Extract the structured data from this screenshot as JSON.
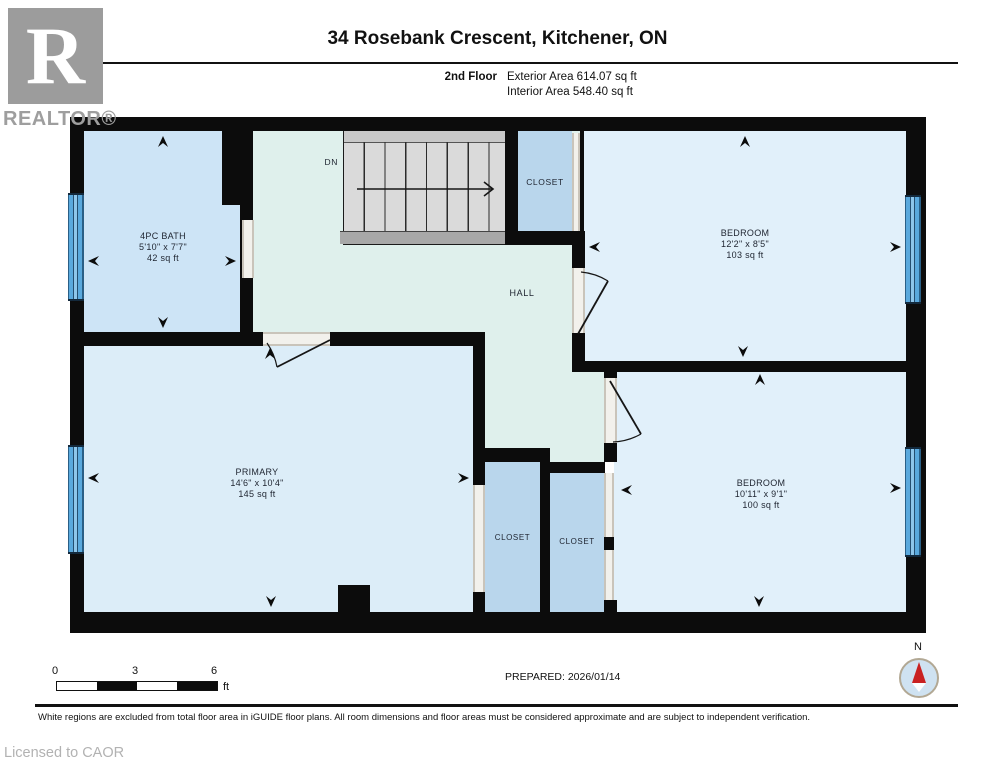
{
  "logo": {
    "symbol": "R",
    "wordmark": "REALTOR®"
  },
  "header": {
    "title": "34 Rosebank Crescent, Kitchener, ON",
    "floor": "2nd Floor",
    "exterior": "Exterior Area 614.07 sq ft",
    "interior": "Interior Area 548.40 sq ft"
  },
  "rooms": {
    "bath": {
      "name": "4PC BATH",
      "dims": "5'10\" x 7'7\"",
      "area": "42 sq ft"
    },
    "bedroom_top": {
      "name": "BEDROOM",
      "dims": "12'2\" x 8'5\"",
      "area": "103 sq ft"
    },
    "primary": {
      "name": "PRIMARY",
      "dims": "14'6\" x 10'4\"",
      "area": "145 sq ft"
    },
    "bedroom_bottom": {
      "name": "BEDROOM",
      "dims": "10'11\" x 9'1\"",
      "area": "100 sq ft"
    },
    "hall": "HALL",
    "closet_top": "CLOSET",
    "closet_left": "CLOSET",
    "closet_right": "CLOSET",
    "stairs_direction": "DN"
  },
  "footer": {
    "scale": {
      "start": "0",
      "mid": "3",
      "end": "6",
      "unit": "ft"
    },
    "prepared": "PREPARED: 2026/01/14",
    "compass": "N",
    "disclaimer": "White regions are excluded from total floor area in iGUIDE floor plans. All room dimensions and floor areas must be considered approximate and are subject to independent verification.",
    "licensed": "Licensed to CAOR"
  },
  "colors": {
    "wall": "#0c0c0c",
    "bath_fill": "#cde4f6",
    "bedroom_fill": "#e1f0fa",
    "primary_fill": "#dcedf8",
    "hall_fill": "#dff0ec",
    "closet_fill": "#b9d6ec",
    "window_blue": "#5aa9dd",
    "compass_red": "#c92121"
  }
}
